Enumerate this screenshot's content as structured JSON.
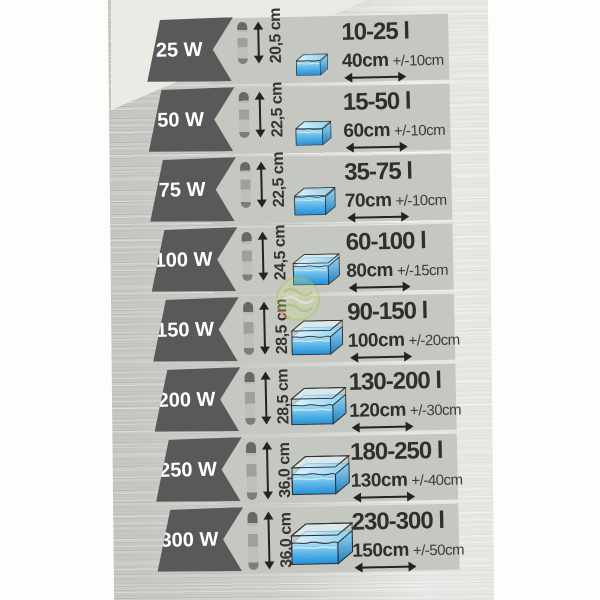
{
  "rows": [
    {
      "watt": "25 W",
      "heater_length": "20,5 cm",
      "volume": "10-25 l",
      "width": "40cm",
      "tolerance": "+/-10cm"
    },
    {
      "watt": "50 W",
      "heater_length": "22,5 cm",
      "volume": "15-50 l",
      "width": "60cm",
      "tolerance": "+/-10cm"
    },
    {
      "watt": "75 W",
      "heater_length": "22,5 cm",
      "volume": "35-75 l",
      "width": "70cm",
      "tolerance": "+/-10cm"
    },
    {
      "watt": "100 W",
      "heater_length": "24,5 cm",
      "volume": "60-100 l",
      "width": "80cm",
      "tolerance": "+/-15cm"
    },
    {
      "watt": "150 W",
      "heater_length": "28,5 cm",
      "volume": "90-150 l",
      "width": "100cm",
      "tolerance": "+/-20cm"
    },
    {
      "watt": "200 W",
      "heater_length": "28,5 cm",
      "volume": "130-200 l",
      "width": "120cm",
      "tolerance": "+/-30cm"
    },
    {
      "watt": "250 W",
      "heater_length": "36,0 cm",
      "volume": "180-250 l",
      "width": "130cm",
      "tolerance": "+/-40cm"
    },
    {
      "watt": "300 W",
      "heater_length": "36,0 cm",
      "volume": "230-300 l",
      "width": "150cm",
      "tolerance": "+/-50cm"
    }
  ],
  "icons": {
    "heater": "heater-tube-icon",
    "length_arrow": "vertical-double-arrow-icon",
    "aquarium": "aquarium-tank-icon",
    "width_arrow": "horizontal-double-arrow-icon",
    "watermark": "green-circular-brand-watermark"
  },
  "colors": {
    "badge_bg": "#595959",
    "panel_bg": "#c5c8c0",
    "text": "#2f2f2f",
    "water_light": "#c9ebfa",
    "water_mid": "#5fb8e8",
    "water_deep": "#2391d8",
    "watermark_green": "#b5cc6e",
    "watermark_orange": "#e08840"
  }
}
